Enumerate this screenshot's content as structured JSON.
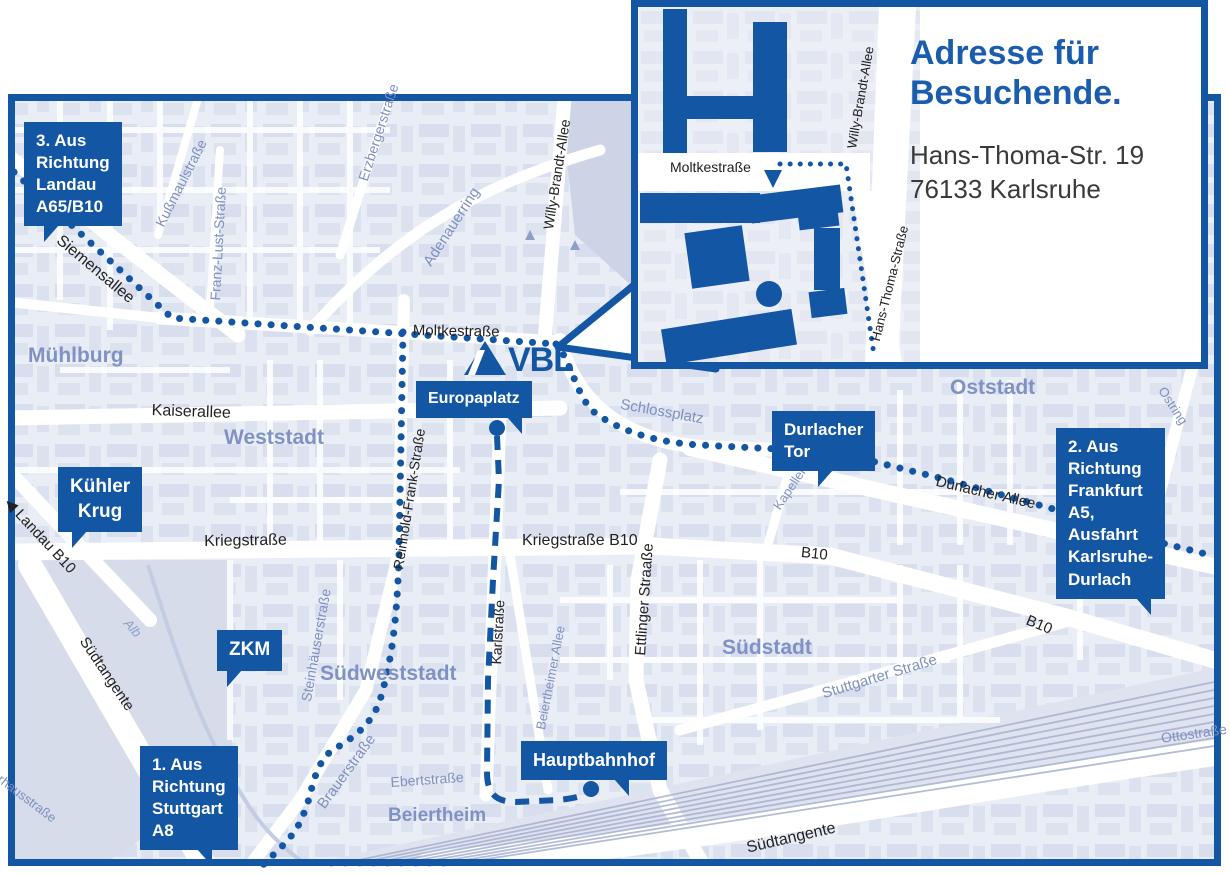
{
  "colors": {
    "brand_blue": "#1356a4",
    "title_blue": "#1a5cad",
    "district_text": "#8091c3",
    "street_blue_text": "#7e90c0",
    "map_background": "#e9edf5"
  },
  "logo": {
    "text": "VBL"
  },
  "inset": {
    "title_line1": "Adresse für",
    "title_line2": "Besuchende.",
    "address_line1": "Hans-Thoma-Str. 19",
    "address_line2": "76133 Karlsruhe",
    "labels": [
      {
        "id": "moltkestrasse-inset",
        "text": "Moltkestraße",
        "x": 32,
        "y": 152,
        "rot": 0,
        "size": 14
      },
      {
        "id": "willy-brandt-allee-inset",
        "text": "Willy-Brandt-Allee",
        "x": 206,
        "y": 140,
        "rot": -80,
        "size": 13
      },
      {
        "id": "hans-thoma-strasse-inset",
        "text": "Hans-Thoma-Straße",
        "x": 230,
        "y": 332,
        "rot": -76,
        "size": 13
      }
    ]
  },
  "callouts": [
    {
      "id": "landau",
      "lines": [
        "3. Aus Richtung",
        "Landau A65/B10"
      ],
      "x": 24,
      "y": 122,
      "size": 17,
      "tail": "bl",
      "tail_off": 20
    },
    {
      "id": "frankfurt",
      "lines": [
        "2. Aus Richtung",
        "Frankfurt A5,",
        "Ausfahrt",
        "Karlsruhe-Durlach"
      ],
      "x": 1056,
      "y": 428,
      "size": 17,
      "tail": "br",
      "tail_off": 14
    },
    {
      "id": "stuttgart",
      "lines": [
        "1. Aus Richtung",
        "Stuttgart A8"
      ],
      "x": 140,
      "y": 746,
      "size": 17,
      "tail": "br",
      "tail_off": 26
    },
    {
      "id": "kuehler-krug",
      "lines": [
        "Kühler",
        "Krug"
      ],
      "x": 58,
      "y": 467,
      "size": 19,
      "tail": "bl",
      "tail_off": 14,
      "center": true
    },
    {
      "id": "zkm",
      "lines": [
        "ZKM"
      ],
      "x": 217,
      "y": 630,
      "size": 19,
      "tail": "bl",
      "tail_off": 10
    },
    {
      "id": "europaplatz",
      "lines": [
        "Europaplatz"
      ],
      "x": 416,
      "y": 381,
      "size": 16,
      "tail": "br",
      "tail_off": 10
    },
    {
      "id": "durlacher-tor",
      "lines": [
        "Durlacher Tor"
      ],
      "x": 772,
      "y": 411,
      "size": 17,
      "tail": "bl",
      "tail_off": 46
    },
    {
      "id": "hauptbahnhof",
      "lines": [
        "Hauptbahnhof"
      ],
      "x": 521,
      "y": 741,
      "size": 18,
      "tail": "br",
      "tail_off": 38
    }
  ],
  "markers": [
    {
      "id": "europaplatz-dot",
      "x": 497,
      "y": 428
    },
    {
      "id": "hauptbahnhof-dot",
      "x": 591,
      "y": 789
    }
  ],
  "map_labels": [
    {
      "id": "siemensallee",
      "text": "Siemensallee",
      "x": 64,
      "y": 232,
      "rot": 40,
      "size": 16,
      "cls": "lab-black"
    },
    {
      "id": "kussmaulstrasse",
      "text": "Kußmaulstraße",
      "x": 152,
      "y": 222,
      "rot": -63,
      "size": 14,
      "cls": "lab-blue"
    },
    {
      "id": "franz-lust-strasse",
      "text": "Franz-Lust-Straße",
      "x": 207,
      "y": 300,
      "rot": -87,
      "size": 14,
      "cls": "lab-blue"
    },
    {
      "id": "erzbergerstrasse",
      "text": "Erzbergerstraße",
      "x": 355,
      "y": 178,
      "rot": -72,
      "size": 14,
      "cls": "lab-blue"
    },
    {
      "id": "adenauerring",
      "text": "Adenauerring",
      "x": 420,
      "y": 260,
      "rot": -57,
      "size": 15,
      "cls": "lab-blue"
    },
    {
      "id": "willy-brandt-allee",
      "text": "Willy-Brandt-Allee",
      "x": 540,
      "y": 228,
      "rot": -81,
      "size": 14,
      "cls": "lab-black"
    },
    {
      "id": "moltkestrasse",
      "text": "Moltkestraße",
      "x": 413,
      "y": 322,
      "rot": 1,
      "size": 15,
      "cls": "lab-black"
    },
    {
      "id": "muehlburg",
      "text": "Mühlburg",
      "x": 28,
      "y": 344,
      "rot": 0,
      "size": 21,
      "cls": "lab-district"
    },
    {
      "id": "kaiserallee",
      "text": "Kaiserallee",
      "x": 152,
      "y": 402,
      "rot": 2,
      "size": 16,
      "cls": "lab-black"
    },
    {
      "id": "weststadt",
      "text": "Weststadt",
      "x": 224,
      "y": 426,
      "rot": 0,
      "size": 21,
      "cls": "lab-district"
    },
    {
      "id": "landau-b10",
      "text": "◀ Landau B10",
      "x": 14,
      "y": 494,
      "rot": 47,
      "size": 15,
      "cls": "lab-black"
    },
    {
      "id": "kriegstrasse",
      "text": "Kriegstraße",
      "x": 204,
      "y": 533,
      "rot": -1,
      "size": 16,
      "cls": "lab-black"
    },
    {
      "id": "kriegstrasse-b10",
      "text": "Kriegstraße B10",
      "x": 522,
      "y": 532,
      "rot": 0,
      "size": 16,
      "cls": "lab-black"
    },
    {
      "id": "reinhold-frank-strasse",
      "text": "Reinhold-Frank-Straße",
      "x": 390,
      "y": 568,
      "rot": -81,
      "size": 14,
      "cls": "lab-black"
    },
    {
      "id": "karlstrasse",
      "text": "Karlstraße",
      "x": 488,
      "y": 664,
      "rot": -87,
      "size": 14,
      "cls": "lab-black"
    },
    {
      "id": "ettlinger-strasse",
      "text": "Ettlinger Straaße",
      "x": 632,
      "y": 655,
      "rot": -86,
      "size": 15,
      "cls": "lab-black"
    },
    {
      "id": "steinhaeuserstrasse",
      "text": "Steinhäuserstraße",
      "x": 298,
      "y": 700,
      "rot": -80,
      "size": 14,
      "cls": "lab-blue"
    },
    {
      "id": "suedweststadt",
      "text": "Südweststadt",
      "x": 320,
      "y": 662,
      "rot": 0,
      "size": 21,
      "cls": "lab-district"
    },
    {
      "id": "suedtangente-west",
      "text": "Südtangente",
      "x": 90,
      "y": 634,
      "rot": 56,
      "size": 15,
      "cls": "lab-black"
    },
    {
      "id": "alb",
      "text": "Alb",
      "x": 132,
      "y": 616,
      "rot": 48,
      "size": 13,
      "cls": "lab-river"
    },
    {
      "id": "brauerstrasse",
      "text": "Brauerstraße",
      "x": 314,
      "y": 802,
      "rot": -54,
      "size": 15,
      "cls": "lab-blue"
    },
    {
      "id": "ebertstrasse",
      "text": "Ebertstraße",
      "x": 390,
      "y": 774,
      "rot": -4,
      "size": 14,
      "cls": "lab-blue"
    },
    {
      "id": "beiertheim",
      "text": "Beiertheim",
      "x": 388,
      "y": 805,
      "rot": 0,
      "size": 19,
      "cls": "lab-district"
    },
    {
      "id": "beiertheimer-allee",
      "text": "Beiertheimer Allee",
      "x": 533,
      "y": 728,
      "rot": -79,
      "size": 13,
      "cls": "lab-blue"
    },
    {
      "id": "pulverhausstrasse",
      "text": "Pulverhausstraße",
      "x": -22,
      "y": 752,
      "rot": 37,
      "size": 13,
      "cls": "lab-blue"
    },
    {
      "id": "schlossplatz",
      "text": "Schlossplatz",
      "x": 622,
      "y": 396,
      "rot": 10,
      "size": 15,
      "cls": "lab-blue"
    },
    {
      "id": "kapellenstrasse",
      "text": "Kapellenstraße",
      "x": 770,
      "y": 504,
      "rot": -56,
      "size": 13,
      "cls": "lab-blue"
    },
    {
      "id": "durlacher-allee",
      "text": "Durlacher Allee",
      "x": 938,
      "y": 473,
      "rot": 13,
      "size": 15,
      "cls": "lab-black"
    },
    {
      "id": "b10-west",
      "text": "B10",
      "x": 802,
      "y": 544,
      "rot": 6,
      "size": 15,
      "cls": "lab-black"
    },
    {
      "id": "b10-east",
      "text": "B10",
      "x": 1030,
      "y": 612,
      "rot": 22,
      "size": 15,
      "cls": "lab-black"
    },
    {
      "id": "suedstadt",
      "text": "Südstadt",
      "x": 722,
      "y": 636,
      "rot": 0,
      "size": 21,
      "cls": "lab-district"
    },
    {
      "id": "stuttgarter-strasse",
      "text": "Stuttgarter Straße",
      "x": 820,
      "y": 686,
      "rot": -17,
      "size": 15,
      "cls": "lab-blue"
    },
    {
      "id": "oststadt",
      "text": "Oststadt",
      "x": 950,
      "y": 376,
      "rot": 0,
      "size": 21,
      "cls": "lab-district"
    },
    {
      "id": "ostring",
      "text": "Ostring",
      "x": 1168,
      "y": 384,
      "rot": 57,
      "size": 13,
      "cls": "lab-blue"
    },
    {
      "id": "ottostrasse",
      "text": "Ottostraße",
      "x": 1160,
      "y": 730,
      "rot": -8,
      "size": 14,
      "cls": "lab-blue"
    },
    {
      "id": "suedtangente-sued",
      "text": "Südtangente",
      "x": 745,
      "y": 840,
      "rot": -13,
      "size": 16,
      "cls": "lab-black"
    }
  ]
}
